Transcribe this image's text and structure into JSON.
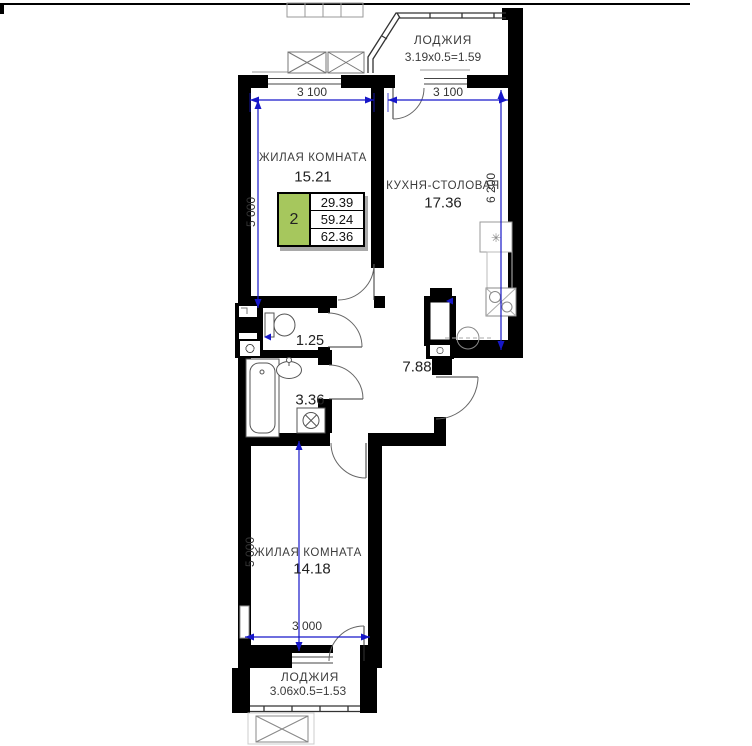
{
  "legend": {
    "rooms_count": "2",
    "living_area": "29.39",
    "floor_area": "59.24",
    "total_area": "62.36",
    "accent_color": "#a6c75d",
    "accent_style": "background:#a6c75d"
  },
  "rooms": {
    "loggia_top": {
      "name": "ЛОДЖИЯ",
      "dims": "3.19x0.5=1.59"
    },
    "living_top": {
      "name": "ЖИЛАЯ КОМНАТА",
      "area": "15.21"
    },
    "kitchen": {
      "name": "КУХНЯ-СТОЛОВАЯ",
      "area": "17.36"
    },
    "wc": {
      "area": "1.25"
    },
    "bathroom": {
      "area": "3.36"
    },
    "hall": {
      "area": "7.88"
    },
    "living_bottom": {
      "name": "ЖИЛАЯ КОМНАТА",
      "area": "14.18"
    },
    "loggia_bottom": {
      "name": "ЛОДЖИЯ",
      "dims": "3.06x0.5=1.53"
    }
  },
  "dimensions": {
    "top_left_width": "3 100",
    "top_right_width": "3 100",
    "living_top_height": "5 000",
    "kitchen_height": "6 200",
    "living_bottom_height": "5 000",
    "living_bottom_width": "3 000",
    "line_color": "#1717c9"
  },
  "icons": {
    "stove": "✳"
  }
}
